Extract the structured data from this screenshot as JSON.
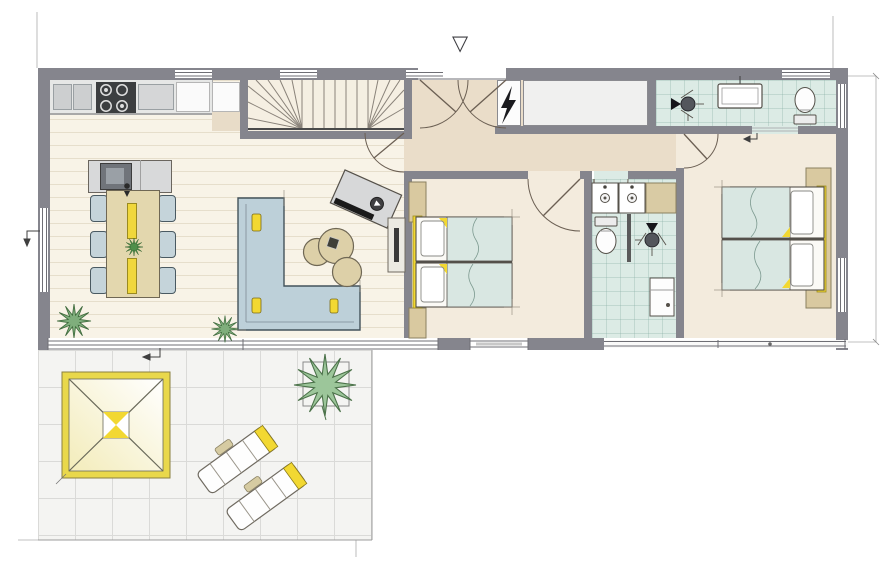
{
  "floorplan": {
    "type": "architectural-floor-plan-holiday-home",
    "entry_marker": "▽",
    "palette": {
      "wall_gray": "#85858d",
      "living_floor": "#f8f3e7",
      "hall_floor": "#eaddc9",
      "bedroom_floor": "#f3ebdd",
      "bath_tile": "#dcebe5",
      "accent_yellow": "#f2d832",
      "sofa_blue": "#bdd0d9",
      "wood_tan": "#e3d7ae",
      "plant_green": "#7fae7c",
      "terrace_tile": "#f4f4f2"
    },
    "rooms": [
      {
        "name": "living-kitchen-dining"
      },
      {
        "name": "staircase"
      },
      {
        "name": "entrance-hall"
      },
      {
        "name": "tech-closet"
      },
      {
        "name": "storage-closet"
      },
      {
        "name": "ensuite-bathroom"
      },
      {
        "name": "bedroom-1"
      },
      {
        "name": "main-bathroom"
      },
      {
        "name": "bedroom-2"
      },
      {
        "name": "terrace"
      }
    ],
    "furniture": [
      "kitchen-counter",
      "cooktop",
      "kitchen-island-sink",
      "dining-table",
      "dining-chairs-x6",
      "l-shaped-sofa",
      "coffee-table-set",
      "tv-board",
      "sideboard",
      "twin-bed-pair-x2",
      "wardrobe-nightstands",
      "double-washbasin",
      "toilet-x2",
      "shower-x2",
      "radiator",
      "pergola",
      "sun-lounger-x2",
      "planter-shrub",
      "potted-plant-x2",
      "electrical-panel"
    ]
  }
}
